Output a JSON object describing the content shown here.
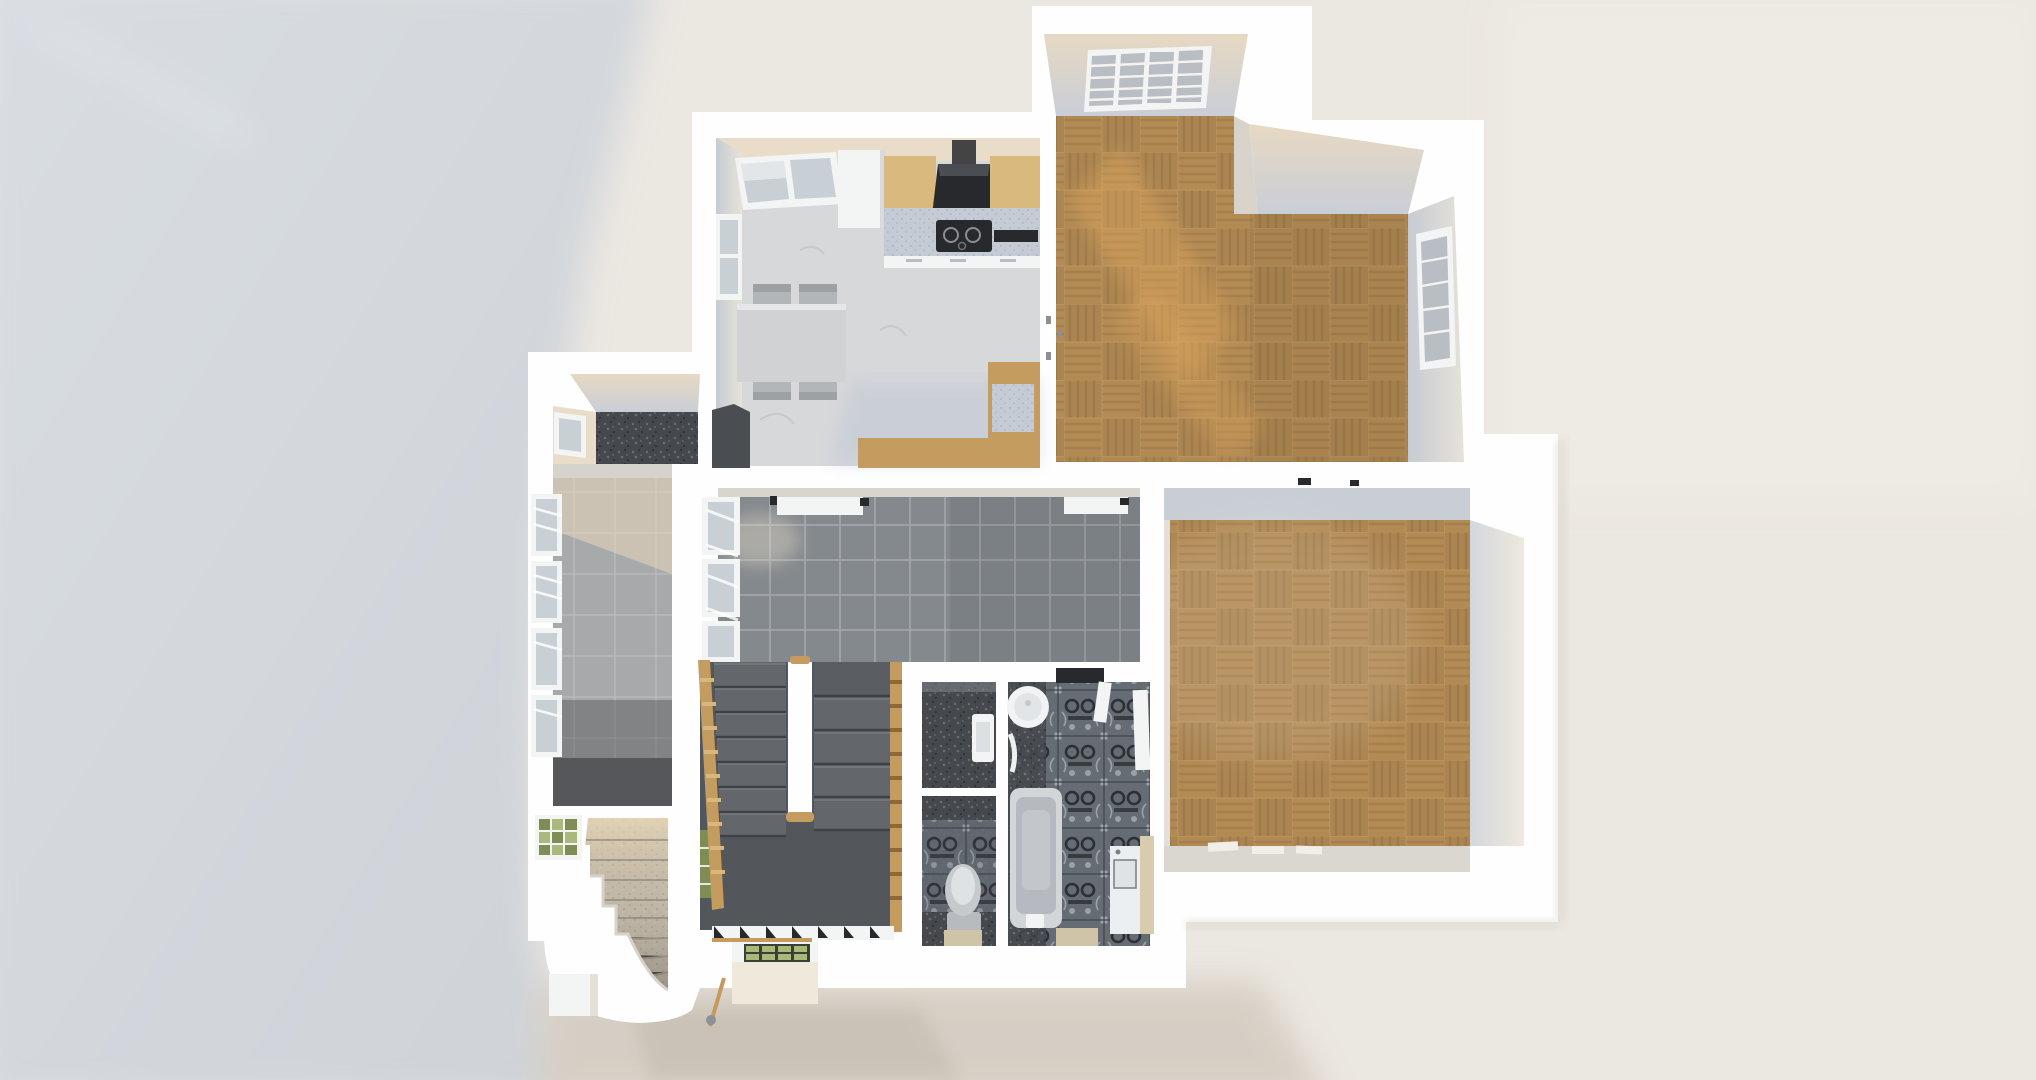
{
  "scene": {
    "type": "3d-floorplan-render",
    "view": "top-down orthographic render, afternoon sunlight from upper right, large cool cast shadow to the left",
    "title": "3D rendered floor plan — top-down view"
  },
  "rooms": [
    {
      "id": "kitchen",
      "label": "Kitchen / dining room",
      "floor": "white marble"
    },
    {
      "id": "living-room",
      "label": "Living room (L-shaped)",
      "floor": "oak basket-weave parquet"
    },
    {
      "id": "bedroom",
      "label": "Bedroom",
      "floor": "oak basket-weave parquet"
    },
    {
      "id": "hallway",
      "label": "Hallway",
      "floor": "grey ceramic tile"
    },
    {
      "id": "side-room",
      "label": "Side room with window wall",
      "floor": "light grey tile"
    },
    {
      "id": "storage-room",
      "label": "Small storage room",
      "floor": "dark terrazzo"
    },
    {
      "id": "bathroom",
      "label": "Bathroom",
      "floor": "ornate patterned tile"
    },
    {
      "id": "wc",
      "label": "WC",
      "floor": "ornate patterned tile"
    },
    {
      "id": "utility-room",
      "label": "Utility niche",
      "floor": "dark terrazzo"
    },
    {
      "id": "stairwell",
      "label": "Stairwell with double flight and landing",
      "floor": "dark grey"
    },
    {
      "id": "exterior-stairs",
      "label": "Curved exterior stone stairs",
      "floor": "stone"
    }
  ],
  "fixtures": [
    "dining table with four chairs",
    "fridge column",
    "wood kitchen counters",
    "black cooker hood",
    "black induction hob",
    "speckled worktop",
    "black tray",
    "kitchen bench",
    "louvered shutter windows",
    "glass-block window",
    "round washbasin",
    "bathtub",
    "toilet",
    "wall-hung basin",
    "washing machine",
    "bathroom door",
    "open white doors",
    "wooden stair balustrades",
    "green glass skylight box",
    "broom",
    "curved white stair wall"
  ],
  "colors": {
    "bg": "#ebe7e1",
    "shadowCool": "#d3d7dc",
    "shadowCoolLight": "#dde1e6",
    "shadowWarm": "#d2c9bd",
    "wall": "#fefefe",
    "wallFaceCool": "#c9ced5",
    "wallFaceWarm": "#e9dcc8",
    "marble": "#d7d8da",
    "marbleVein": "#c0c3c8",
    "parquetBase": "#b28a54",
    "parquetDark": "#aITALIC37d4a",
    "parquetLight": "#c69f66",
    "sunPatch": "#e3aa5f",
    "hallTile": "#84898e",
    "hallGrout": "#a4a9ae",
    "leftTile": "#a8a9aa",
    "leftGrout": "#bcbdbe",
    "darkFloor": "#45484d",
    "darkFloorDotL": "#686d73",
    "darkFloorDotD": "#2b2d31",
    "ornateBase": "#666c74",
    "ornateDark": "#2c2f35",
    "ornateLight": "#9ba1a9",
    "stone": "#c1b8a8",
    "stoneDot": "#a89f90",
    "counterSpeckle": "#c5cbd5",
    "counterSpeckleDot": "#aab1bd",
    "wood": "#c59c60",
    "woodLight": "#dab97e",
    "stepTread": "#63676c",
    "stepShadow": "#3e4145",
    "landing": "#53575c",
    "fixtureWhite": "#f3f4f4",
    "applianceDark": "#27292d",
    "glassGreen": "#7d8d53",
    "glassGreenLight": "#a9b97c",
    "glassPane": "#c9d0d5",
    "tubOuter": "#d3d6d9",
    "tubInner": "#b6bac0",
    "tableTop": "#d0d2d4",
    "chairGray": "#b3b6b9",
    "benchDark": "#4a4e53"
  }
}
